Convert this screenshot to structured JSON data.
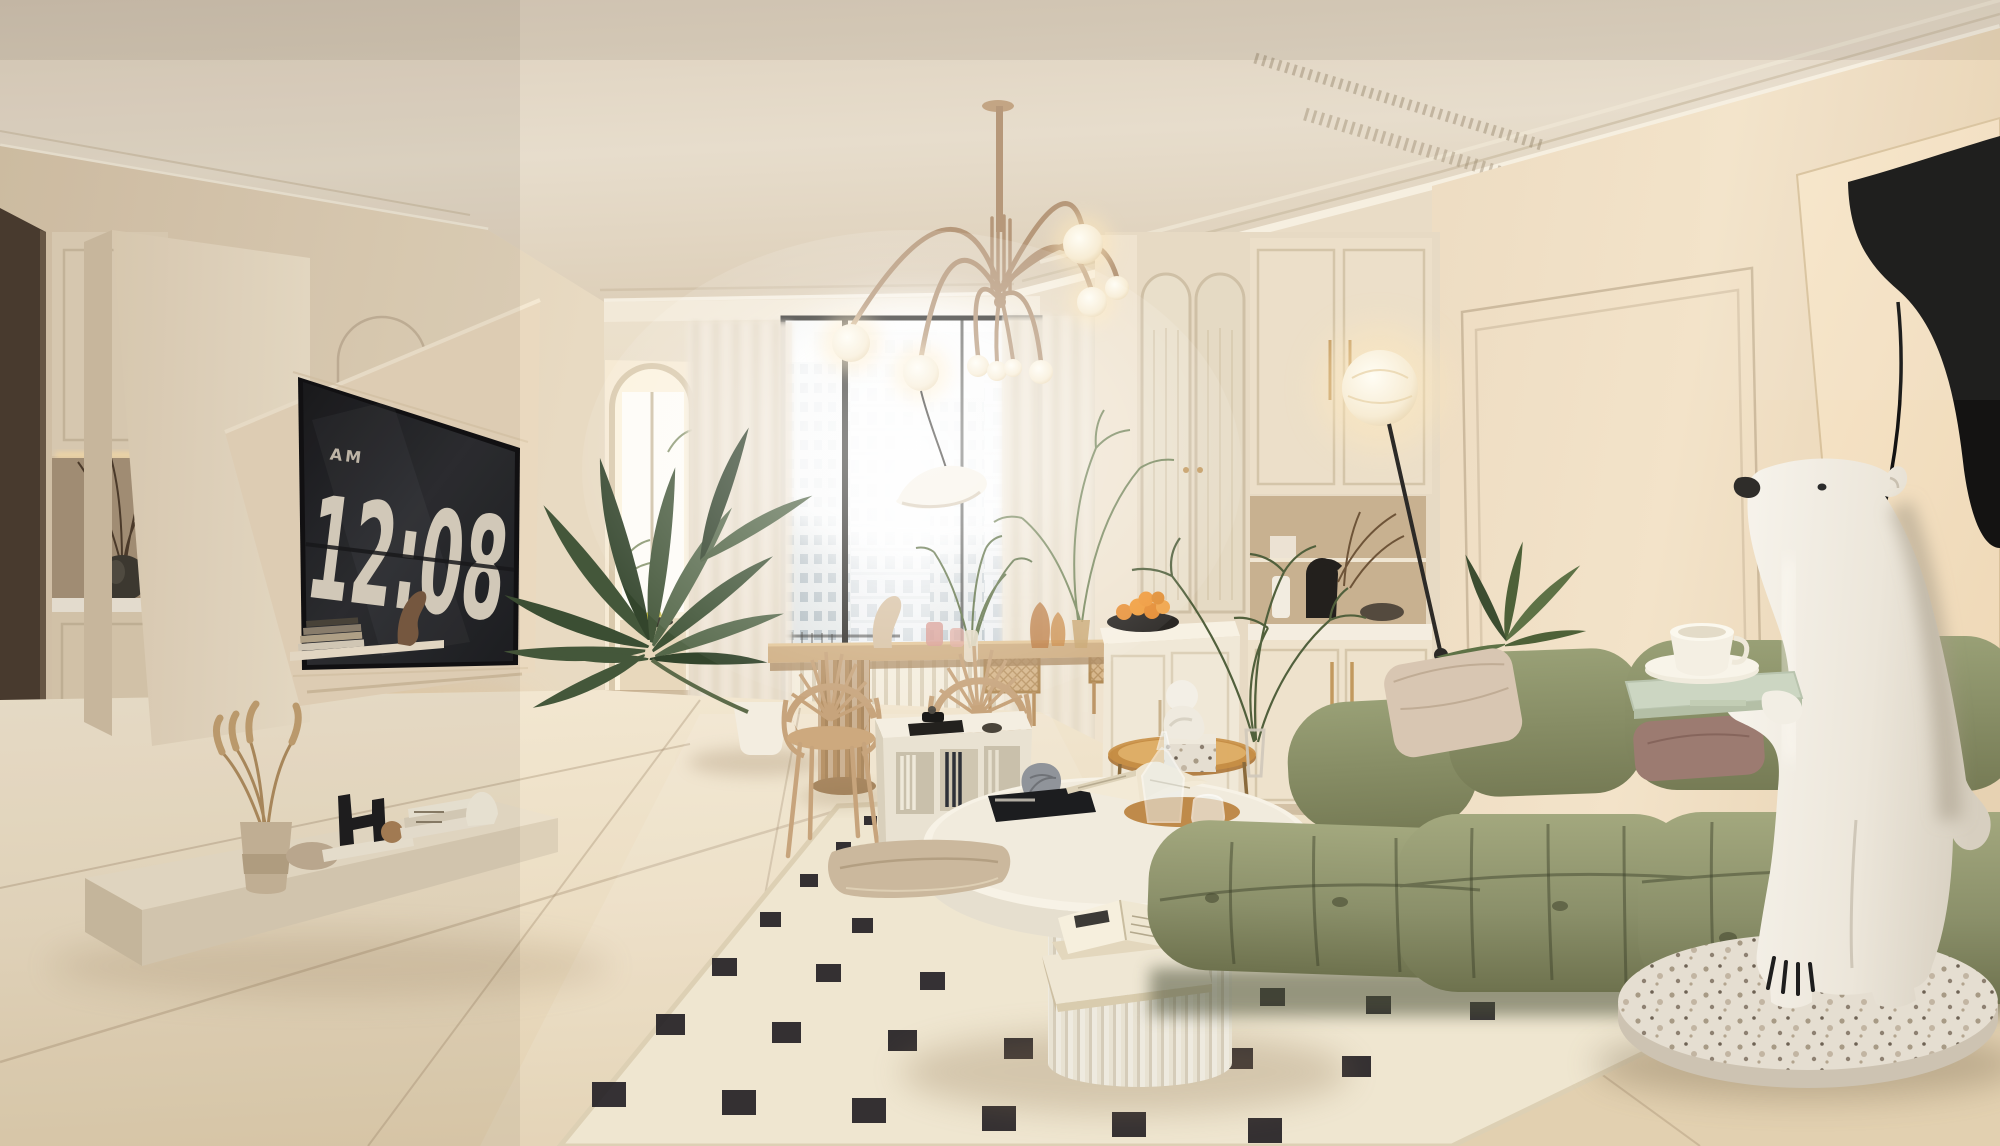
{
  "scene": {
    "description": "Photorealistic cream minimalist living room render: floating media wall with flip-clock TV, fountain brass chandelier, city-view window, rattan dining set, olive green modular sofa, checkered cream rug, white round coffee table and a polar bear statue holding a tea tray",
    "room_style": "warm cream / wabi-sabi modern"
  },
  "tv": {
    "meridiem": "AM",
    "time": "12:08"
  },
  "palette": {
    "ceiling": "#e6dccb",
    "wall_left": "#e3d4bd",
    "wall_back": "#efe5d2",
    "wall_right": "#f0e1c8",
    "floor": "#ead9bd",
    "screen_dark": "#202226",
    "clock_digits": "#ddd4c4",
    "sofa_green": "#8d926c",
    "wood_oak": "#c9a97e",
    "brass": "#b6987a",
    "orange_fruit": "#e8923a",
    "terrazzo": "#e4ddd0",
    "black_accent": "#1c1d1f",
    "white_ceramic": "#f6f1e6"
  }
}
